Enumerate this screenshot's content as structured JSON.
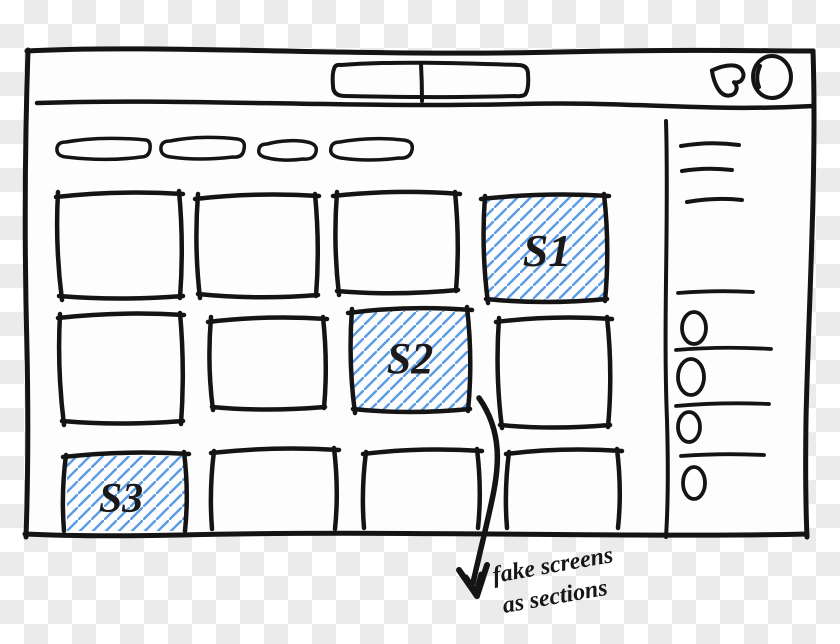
{
  "colors": {
    "ink": "#141414",
    "hatch_blue": "#5b9ce6",
    "paper": "#fdfdfd",
    "checker_gray": "#ebebeb",
    "checker_white": "#ffffff"
  },
  "sections": [
    {
      "label": "S1"
    },
    {
      "label": "S2"
    },
    {
      "label": "S3"
    }
  ],
  "annotation": {
    "line1": "fake screens",
    "line2": "as sections"
  },
  "icons": {
    "top_right": [
      "heart-icon",
      "avatar-circle-icon"
    ]
  },
  "layout_counts": {
    "filter_chips": 4,
    "grid_rows": 3,
    "grid_cols": 4,
    "sidebar_menu_lines": 3,
    "sidebar_list_items": 4
  }
}
